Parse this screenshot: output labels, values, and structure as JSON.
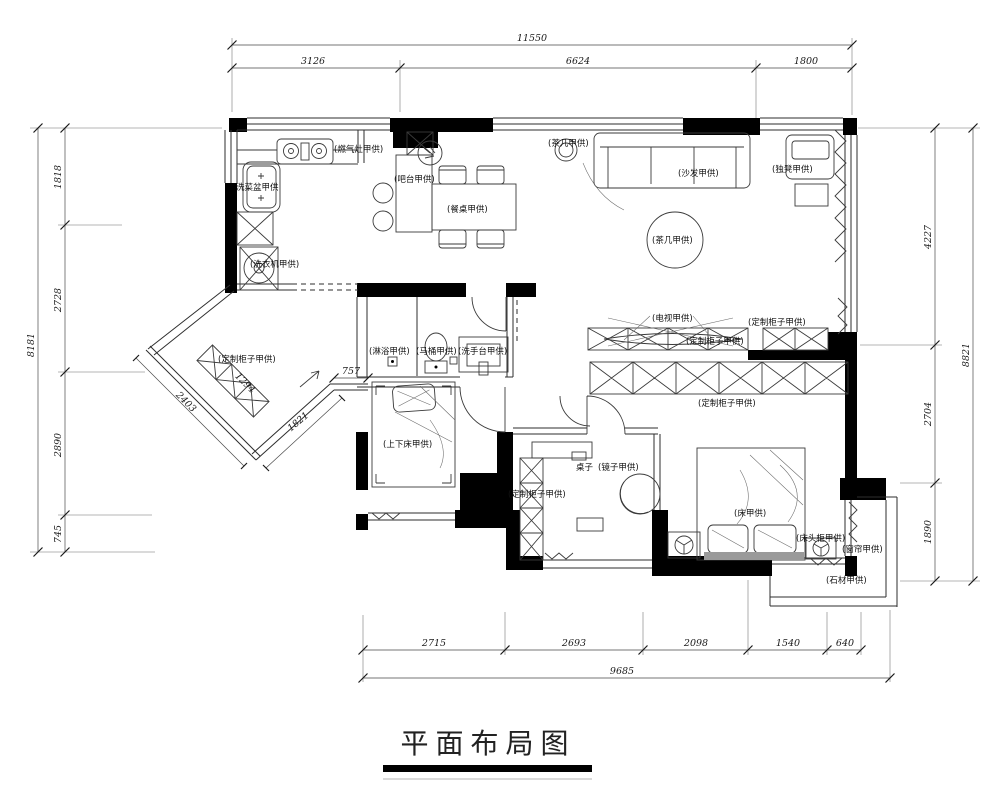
{
  "title": "平面布局图",
  "dimensions": {
    "top": {
      "total": "11550",
      "segments": [
        "3126",
        "6624",
        "1800"
      ]
    },
    "left": {
      "total": "8181",
      "segments": [
        "1818",
        "2728",
        "2890",
        "745"
      ]
    },
    "right": {
      "total": "8821",
      "segments": [
        "4227",
        "2704",
        "1890"
      ]
    },
    "bottom": {
      "total": "9685",
      "segments": [
        "2715",
        "2693",
        "2098",
        "1540",
        "640"
      ]
    },
    "entry_diagonal": {
      "outer": "2403",
      "cabinet": "1294",
      "inner": "1821",
      "offset": "757"
    }
  },
  "labels": {
    "gas_stove": "(燃气灶甲供)",
    "sink": "洗菜盆甲供",
    "washing_machine": "(洗衣机甲供)",
    "bar_counter": "(吧台甲供)",
    "dining_table": "(餐桌甲供)",
    "tea_table": "(茶几甲供)",
    "sofa": "(沙发甲供)",
    "stool": "(独凳甲供)",
    "tv": "(电视甲供)",
    "custom_cabinet": "(定制柜子甲供)",
    "shower": "(淋浴甲供)",
    "toilet": "(马桶甲供)",
    "wash_basin": "(洗手台甲供)",
    "bunk_bed": "(上下床甲供)",
    "desk": "桌子",
    "mirror": "(镜子甲供)",
    "bed": "(床甲供)",
    "bedside_table": "(床头柜甲供)",
    "curtain": "(窗帘甲供)",
    "stone": "(石材甲供)"
  },
  "colors": {
    "wall": "#000000",
    "line": "#2e2e2e",
    "background": "#ffffff",
    "bench": "#9a9a9a"
  }
}
